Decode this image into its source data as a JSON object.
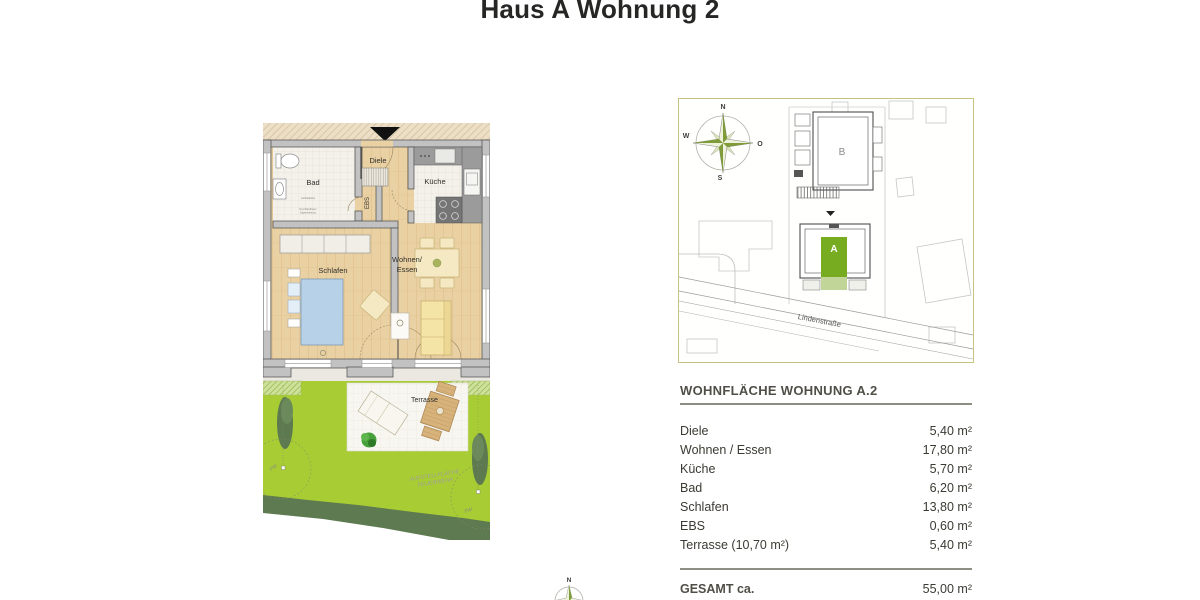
{
  "page": {
    "title": "Haus A Wohnung 2"
  },
  "floorplan": {
    "rooms": {
      "bad": "Bad",
      "diele": "Diele",
      "kueche": "Küche",
      "ebs": "EBS",
      "schlafen": "Schlafen",
      "wohnen_line1": "Wohnen/",
      "wohnen_line2": "Essen",
      "terrasse": "Terrasse"
    },
    "annotations": {
      "fw_left": "FW",
      "fw_right": "FW",
      "feuerwehr_line1": "AUFSTELLFLÄCHE",
      "feuerwehr_line2": "FEUERWEHR",
      "bad_note_1": "Aufstellplatz",
      "bad_note_2": "Durchlaufbarer",
      "bad_note_3": "Eigenleistung"
    }
  },
  "siteplan": {
    "compass": {
      "north": "N",
      "east": "O",
      "south": "S",
      "west": "W"
    },
    "building_a": "A",
    "building_b": "B",
    "street": "Lindenstraße"
  },
  "area_table": {
    "title": "WOHNFLÄCHE WOHNUNG A.2",
    "rows": [
      {
        "label": "Diele",
        "value": "5,40 m²"
      },
      {
        "label": "Wohnen / Essen",
        "value": "17,80 m²"
      },
      {
        "label": "Küche",
        "value": "5,70 m²"
      },
      {
        "label": "Bad",
        "value": "6,20 m²"
      },
      {
        "label": "Schlafen",
        "value": "13,80 m²"
      },
      {
        "label": "EBS",
        "value": "0,60 m²"
      },
      {
        "label": "Terrasse (10,70 m²)",
        "value": "5,40 m²"
      }
    ],
    "total_label": "GESAMT ca.",
    "total_value": "55,00 m²"
  },
  "bottom_compass": {
    "north": "N"
  },
  "colors": {
    "highlight_green": "#77ac20",
    "lawn_green": "#a7cc34",
    "hedge_green": "#5e7a50",
    "wood_floor": "#ead1a3",
    "wall_gray": "#c2c2c2",
    "bed_blue": "#b7d1e9",
    "sofa_yellow": "#f4e4a6",
    "siteplan_border": "#c6c282",
    "text_dark": "#3b3a33"
  }
}
